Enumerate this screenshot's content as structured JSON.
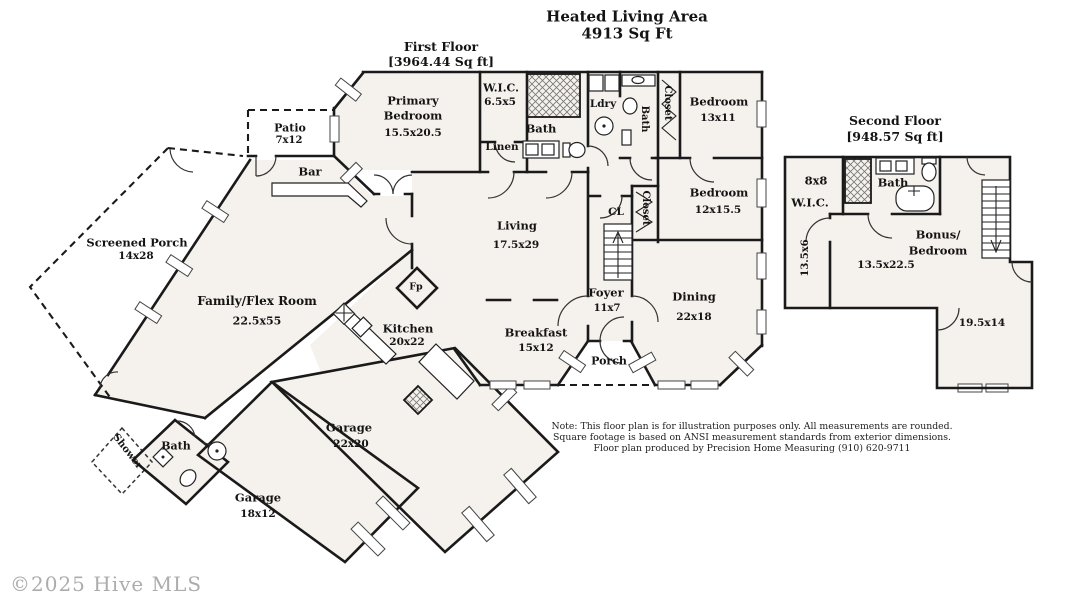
{
  "colors": {
    "wall": "#1a1a1a",
    "room_fill": "#f5f1ec",
    "label_text": "#141414",
    "copyright_gray": "#acacac"
  },
  "title": {
    "line1": "Heated Living Area",
    "line2": "4913 Sq Ft"
  },
  "first_floor": {
    "heading1": "First Floor",
    "heading2": "[3964.44 Sq ft]",
    "rooms": {
      "primary_bedroom": {
        "line1": "Primary",
        "line2": "Bedroom",
        "dims": "15.5x20.5"
      },
      "wic": {
        "name": "W.I.C.",
        "dims": "6.5x5"
      },
      "bath_primary": {
        "name": "Bath"
      },
      "linen": {
        "name": "Linen"
      },
      "laundry": {
        "name": "Ldry"
      },
      "bath_hall": {
        "name": "Bath"
      },
      "closet_bedroom1": {
        "name": "Closet"
      },
      "bedroom1": {
        "name": "Bedroom",
        "dims": "13x11"
      },
      "bedroom2": {
        "name": "Bedroom",
        "dims": "12x15.5"
      },
      "closet_bedroom2": {
        "name": "Closet"
      },
      "hall_closet": {
        "name": "CL"
      },
      "patio": {
        "name": "Patio",
        "dims": "7x12"
      },
      "bar": {
        "name": "Bar"
      },
      "screened_porch": {
        "name": "Screened Porch",
        "dims": "14x28"
      },
      "family_flex": {
        "name": "Family/Flex Room",
        "dims": "22.5x55"
      },
      "living": {
        "name": "Living",
        "dims": "17.5x29"
      },
      "foyer": {
        "name": "Foyer",
        "dims": "11x7"
      },
      "dining": {
        "name": "Dining",
        "dims": "22x18"
      },
      "breakfast": {
        "name": "Breakfast",
        "dims": "15x12"
      },
      "kitchen": {
        "name": "Kitchen",
        "dims": "20x22"
      },
      "fireplace": {
        "name": "Fp"
      },
      "porch": {
        "name": "Porch"
      },
      "shower": {
        "name": "Shower"
      },
      "bath_garage": {
        "name": "Bath"
      },
      "garage_main": {
        "name": "Garage",
        "dims": "22x20"
      },
      "garage_second": {
        "name": "Garage",
        "dims": "18x12"
      }
    }
  },
  "second_floor": {
    "heading1": "Second Floor",
    "heading2": "[948.57 Sq ft]",
    "rooms": {
      "wic": {
        "dims": "8x8",
        "name": "W.I.C."
      },
      "bath": {
        "name": "Bath"
      },
      "bonus": {
        "line1": "Bonus/",
        "line2": "Bedroom",
        "dims": "13.5x22.5"
      },
      "hall": {
        "dims": "13.5x6"
      },
      "rear_room": {
        "dims": "19.5x14"
      }
    }
  },
  "note": {
    "line1": "Note: This floor plan is for illustration purposes only. All measurements are rounded.",
    "line2": "Square footage is based on ANSI measurement standards from exterior dimensions.",
    "line3": "Floor plan produced by Precision Home Measuring (910) 620-9711"
  },
  "copyright": "©2025 Hive MLS"
}
